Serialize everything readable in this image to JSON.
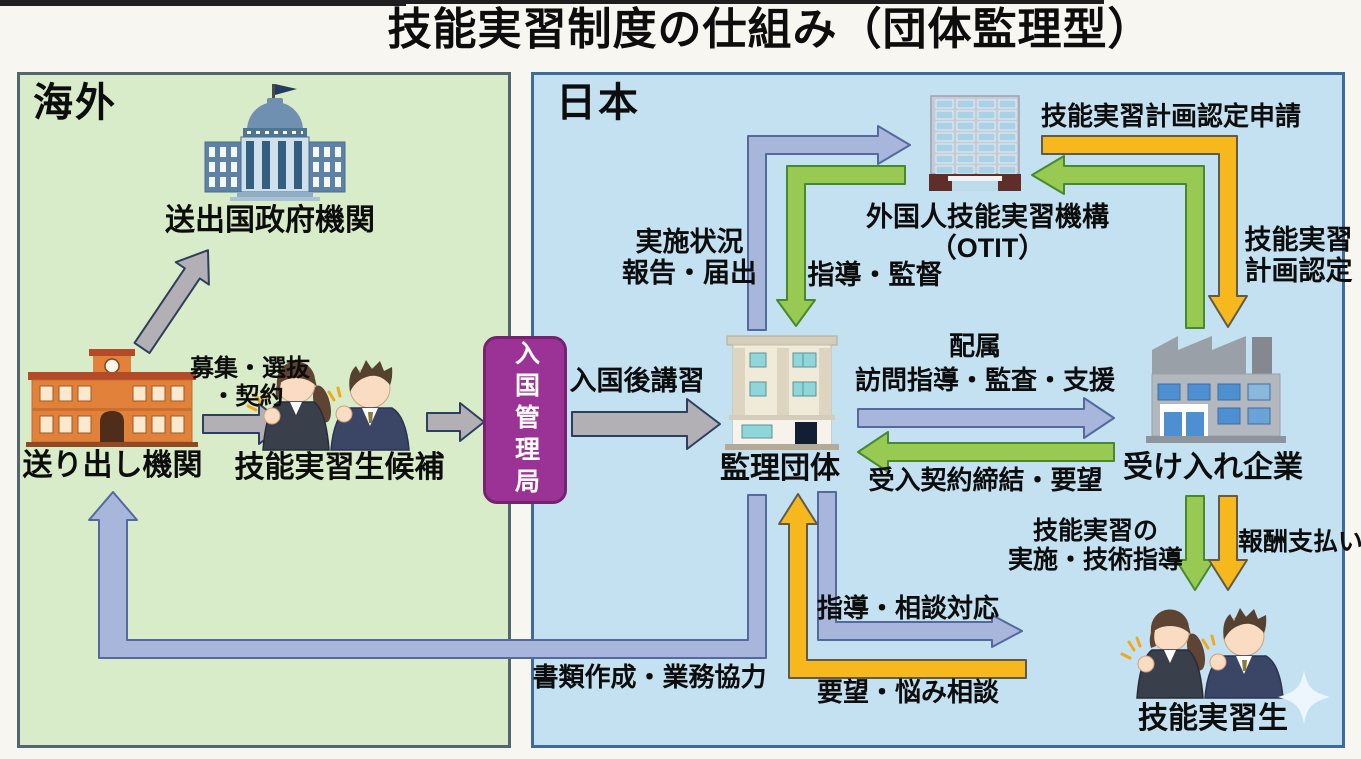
{
  "title": "技能実習制度の仕組み（団体監理型）",
  "regions": {
    "overseas": "海外",
    "japan": "日本"
  },
  "nodes": {
    "government": "送出国政府機関",
    "sending_org": "送り出し機関",
    "candidates": "技能実習生候補",
    "immigration": "入国管理局",
    "supervising_org": "監理団体",
    "otit_line1": "外国人技能実習機構",
    "otit_line2": "（OTIT）",
    "company": "受け入れ企業",
    "trainees": "技能実習生"
  },
  "labels": {
    "recruit_line1": "募集・選抜",
    "recruit_line2": "・契約",
    "post_entry_training": "入国後講習",
    "report_line1": "実施状況",
    "report_line2": "報告・届出",
    "guidance_supervision": "指導・監督",
    "plan_application": "技能実習計画認定申請",
    "plan_cert_line1": "技能実習",
    "plan_cert_line2": "計画認定",
    "assignment": "配属",
    "visit_guidance": "訪問指導・監査・支援",
    "acceptance_contract": "受入契約締結・要望",
    "training_line1": "技能実習の",
    "training_line2": "実施・技術指導",
    "salary_payment": "報酬支払い",
    "guidance_consult": "指導・相談対応",
    "request_consult": "要望・悩み相談",
    "document_cooperation": "書類作成・業務協力"
  },
  "colors": {
    "panel_overseas": "#d9ecc9",
    "panel_japan": "#c3e1f0",
    "immigration_box": "#9b3295",
    "arrow_gray": "#b2b0b4",
    "arrow_blue": "#a9b6db",
    "arrow_green": "#98c952",
    "arrow_yellow": "#f6b81d"
  }
}
